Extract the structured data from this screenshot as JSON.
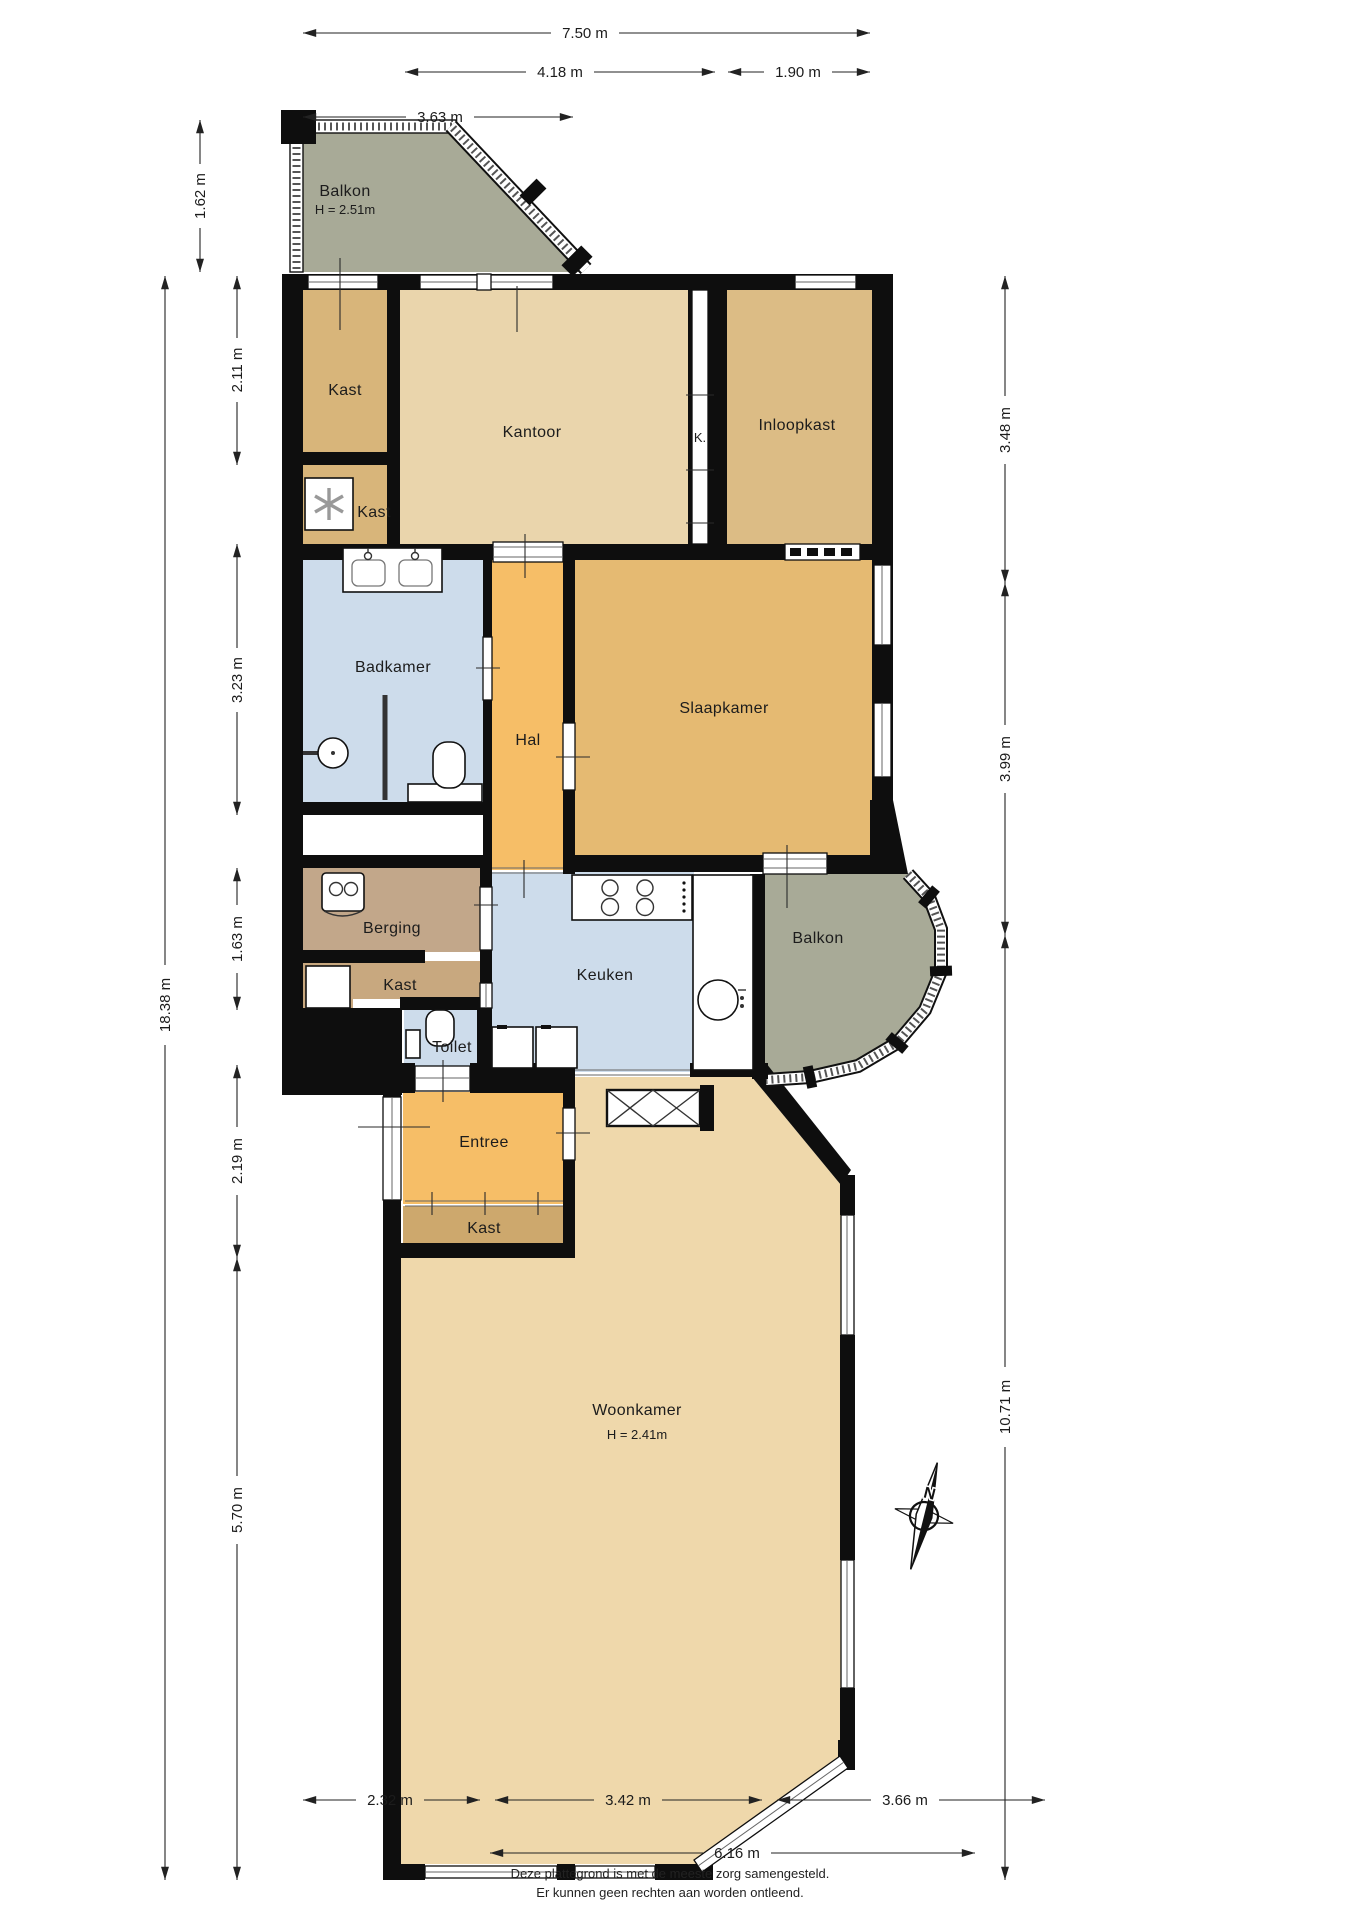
{
  "rooms": {
    "balkon_top": {
      "label": "Balkon",
      "height": "H = 2.51m"
    },
    "kast_1": {
      "label": "Kast"
    },
    "kantoor": {
      "label": "Kantoor"
    },
    "k_strip": {
      "label": "K."
    },
    "inloopkast": {
      "label": "Inloopkast"
    },
    "kast_2": {
      "label": "Kast"
    },
    "badkamer": {
      "label": "Badkamer"
    },
    "hal": {
      "label": "Hal"
    },
    "slaapkamer": {
      "label": "Slaapkamer"
    },
    "berging": {
      "label": "Berging"
    },
    "kast_3": {
      "label": "Kast"
    },
    "keuken": {
      "label": "Keuken"
    },
    "balkon_right": {
      "label": "Balkon"
    },
    "toilet": {
      "label": "Toilet"
    },
    "entree": {
      "label": "Entree"
    },
    "kast_4": {
      "label": "Kast"
    },
    "woonkamer": {
      "label": "Woonkamer",
      "height": "H = 2.41m"
    }
  },
  "dimensions": {
    "top": {
      "total": "7.50 m",
      "left_span": "4.18 m",
      "right_span": "1.90 m",
      "sub_left": "3.63 m"
    },
    "left": {
      "s1": "1.62 m",
      "s2": "2.11 m",
      "s3": "3.23 m",
      "s4": "1.63 m",
      "s5": "2.19 m",
      "s6": "5.70 m",
      "total": "18.38 m"
    },
    "right": {
      "s1": "3.48 m",
      "s2": "3.99 m",
      "s3": "10.71 m"
    },
    "bottom": {
      "s1": "2.32 m",
      "s2": "3.42 m",
      "s3": "3.66 m",
      "total": "6.16 m"
    }
  },
  "compass": {
    "label": "N"
  },
  "footer": {
    "line1": "Deze plattegrond is met de meeste zorg samengesteld.",
    "line2": "Er kunnen geen rechten aan worden ontleend."
  },
  "colors": {
    "wall": "#0e0e0e",
    "balcony": "#a8aa97",
    "closet": "#d8b57a",
    "walkin": "#dcbc85",
    "office": "#ead5ac",
    "bedroom": "#e5ba72",
    "hall": "#f6be67",
    "wet": "#cddceb",
    "storage": "#c2a78a",
    "storage_closet": "#c8a87f",
    "entry_closet": "#cda86d",
    "living": "#efd8ab"
  }
}
